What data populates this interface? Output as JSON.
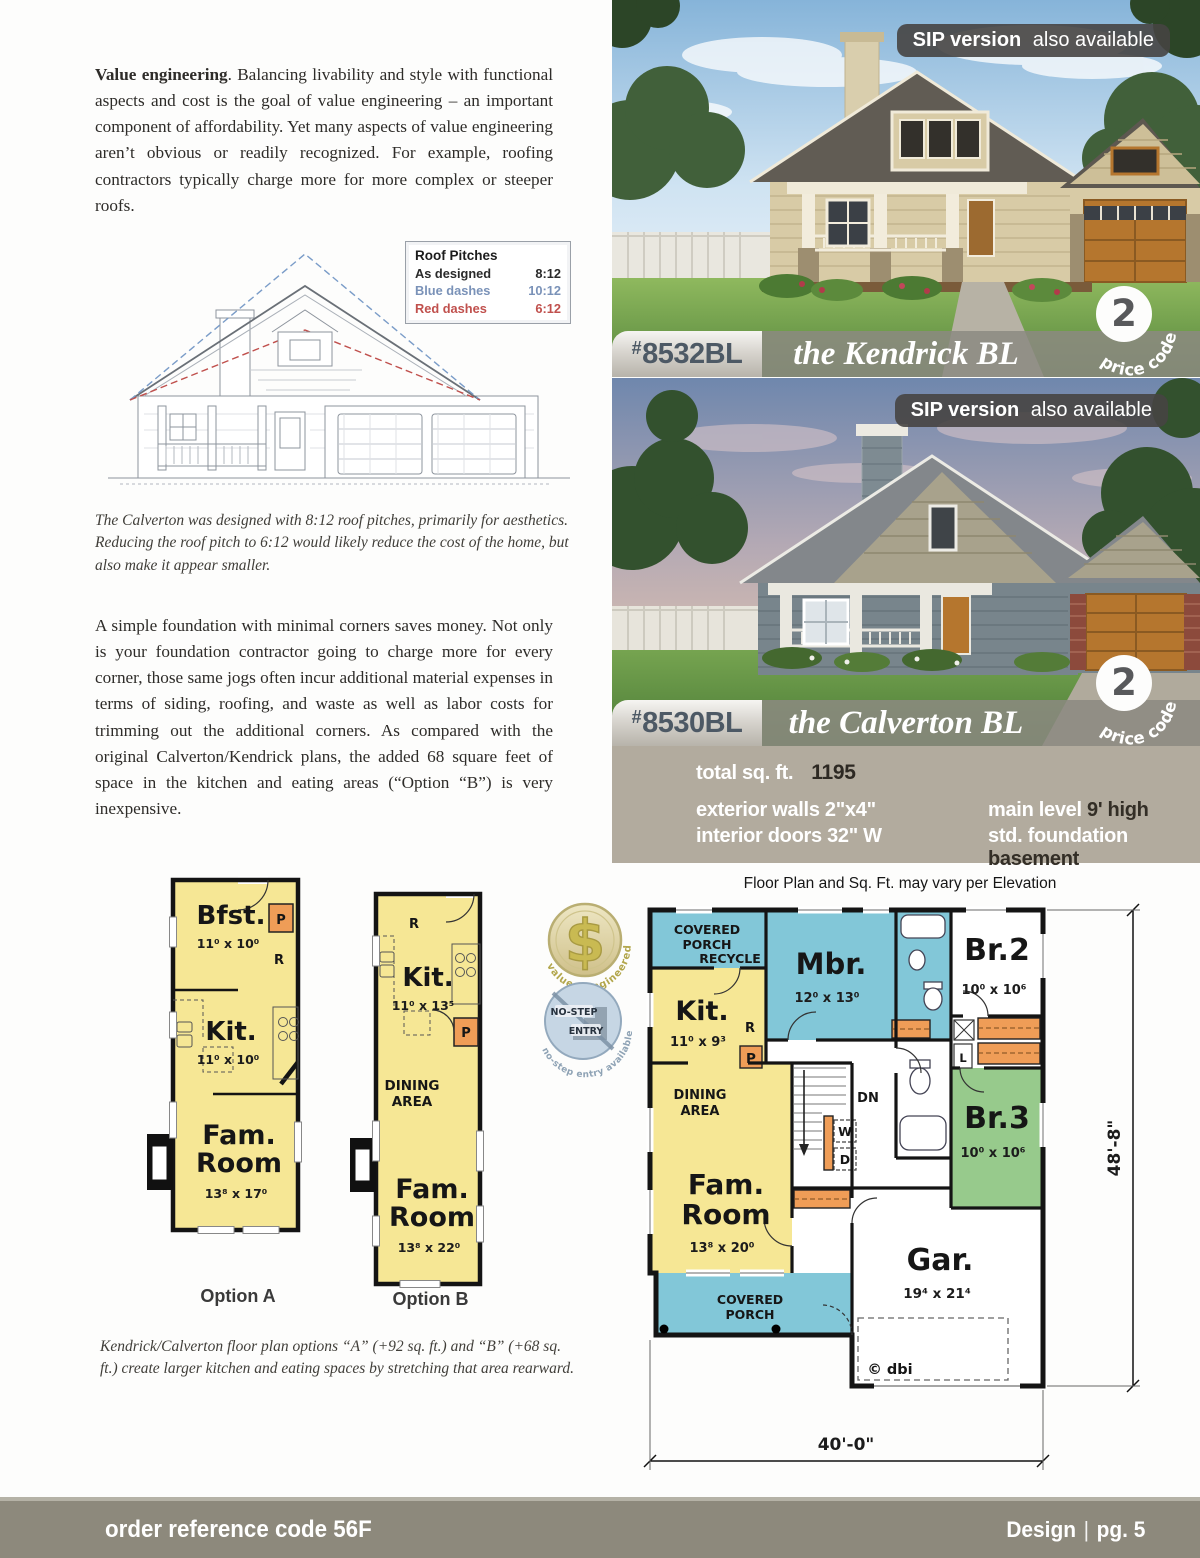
{
  "colors": {
    "plan_yellow": "#f6e795",
    "plan_blue": "#82c7d8",
    "plan_green": "#97ca8c",
    "plan_orange": "#ef9d57",
    "specs_bg": "#b2ab9e",
    "footer_bg": "#8d897c",
    "legend_blue": "#7a92b8",
    "legend_red": "#c0504d"
  },
  "article": {
    "para1_lead": "Value engineering",
    "para1_rest": ". Balancing livability and style with functional aspects and cost is the goal of value engineering – an important component of affordability. Yet many aspects of value engineering aren’t obvious or readily recognized. For example, roofing contractors typically charge more for more complex or steeper roofs.",
    "caption1": "The Calverton was designed with 8:12 roof pitches, primarily for aesthetics. Reducing the roof pitch to 6:12 would likely reduce the cost of the home, but also make it appear smaller.",
    "para2": "A simple foundation with minimal corners saves money. Not only is your foundation contractor going to charge more for every corner, those same jogs often incur additional material expenses in terms of siding, roofing, and waste as well as labor costs for trimming out the additional corners. As compared with the original Calverton/Kendrick plans, the added 68 square feet of space in the kitchen and eating areas (“Option “B”) is very inexpensive.",
    "caption2": "Kendrick/Calverton floor plan options “A”  (+92 sq. ft.) and “B” (+68 sq. ft.) create larger kitchen and eating spaces by stretching that area rearward."
  },
  "legend": {
    "title": "Roof Pitches",
    "as_label": "As designed",
    "as_value": "8:12",
    "blue_label": "Blue dashes",
    "blue_value": "10:12",
    "red_label": "Red dashes",
    "red_value": "6:12"
  },
  "badges": {
    "dollar_symbol": "$",
    "dollar_arc": "value - engineered",
    "nostep_line1": "NO-STEP",
    "nostep_line2": "ENTRY",
    "nostep_arc": "no-step entry available"
  },
  "houses": [
    {
      "sip_bold": "SIP version",
      "sip_rest": " also available",
      "hash": "#",
      "number": "8532BL",
      "name": "the Kendrick BL",
      "price": "2",
      "price_label": "price code"
    },
    {
      "sip_bold": "SIP version",
      "sip_rest": " also available",
      "hash": "#",
      "number": "8530BL",
      "name": "the Calverton BL",
      "price": "2",
      "price_label": "price code"
    }
  ],
  "specs": {
    "total_label": "total sq. ft.",
    "total_value": "1195",
    "rows": [
      {
        "label": "exterior walls",
        "value": "2\"x4\""
      },
      {
        "label": "interior doors",
        "value": "32\" W"
      },
      {
        "label": "main level",
        "value": "9' high"
      },
      {
        "label": "std. foundation",
        "value": "basement"
      }
    ]
  },
  "plan_note": "Floor Plan and Sq. Ft. may vary per Elevation",
  "option_a": {
    "label": "Option A",
    "bfst": "Bfst.",
    "bfst_dims": "11⁰ x 10⁰",
    "kit": "Kit.",
    "kit_dims": "11⁰ x 10⁰",
    "fam1": "Fam.",
    "fam2": "Room",
    "fam_dims": "13⁸ x 17⁰",
    "p": "P",
    "r": "R"
  },
  "option_b": {
    "label": "Option B",
    "kit": "Kit.",
    "kit_dims": "11⁰ x 13⁵",
    "dining1": "DINING",
    "dining2": "AREA",
    "fam1": "Fam.",
    "fam2": "Room",
    "fam_dims": "13⁸ x 22⁰",
    "p": "P",
    "r": "R"
  },
  "main_plan": {
    "porch1": "COVERED",
    "porch2": "PORCH",
    "recycle": "RECYCLE",
    "mbr": "Mbr.",
    "mbr_dims": "12⁰ x 13⁰",
    "br2": "Br.2",
    "br2_dims": "10⁰ x 10⁶",
    "kit": "Kit.",
    "kit_dims": "11⁰ x 9³",
    "r": "R",
    "p": "P",
    "l": "L",
    "dn": "DN",
    "w": "W",
    "d": "D",
    "dining1": "DINING",
    "dining2": "AREA",
    "br3": "Br.3",
    "br3_dims": "10⁰ x 10⁶",
    "fam1": "Fam.",
    "fam2": "Room",
    "fam_dims": "13⁸ x 20⁰",
    "porchb1": "COVERED",
    "porchb2": "PORCH",
    "gar": "Gar.",
    "gar_dims": "19⁴ x 21⁴",
    "dbi": "© dbi",
    "dim_w": "40'-0\"",
    "dim_h": "48'-8\""
  },
  "footer": {
    "left": "order reference code 56F",
    "right_name": "Design",
    "right_sep": "|",
    "right_page": "pg. 5"
  }
}
